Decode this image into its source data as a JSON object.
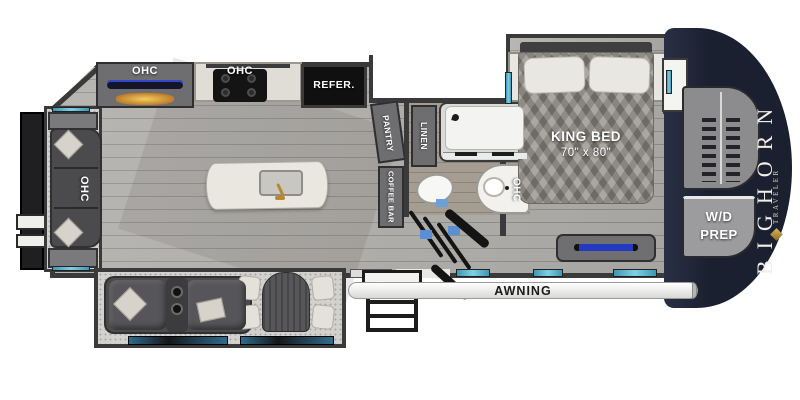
{
  "page": {
    "type": "rv-floorplan"
  },
  "brand": {
    "name": "BIGHORN",
    "series": "TRAVELER"
  },
  "labels": {
    "sofa_ohc": "OHC",
    "entertainment_ohc": "OHC",
    "kitchen_ohc": "OHC",
    "refrigerator": "REFER.",
    "pantry": "PANTRY",
    "coffee_bar": "COFFEE BAR",
    "linen": "LINEN",
    "bath_ohc": "OHC",
    "king_bed": "KING BED",
    "king_bed_size": "70\" x 80\"",
    "wd_prep_line1": "W/D",
    "wd_prep_line2": "PREP",
    "awning": "AWNING"
  },
  "colors": {
    "wall": "#3a3a3a",
    "floor_wood": "#a7a5a1",
    "bath_floor": "#a59d92",
    "carpet": "#d2d1ce",
    "front_cap_navy": "#1b2030",
    "counter_white": "#e9e6df",
    "appliance_black": "#111111",
    "cabinet_gray": "#6e6e70",
    "window_teal": "#7fd0e4",
    "tv_blue": "#2b3fc4",
    "fireplace_amber": "#e0a43c",
    "faucet_gold": "#b9882e",
    "seating_gray": "#4b4b4e",
    "pillow_cream": "#e9e7e1"
  }
}
